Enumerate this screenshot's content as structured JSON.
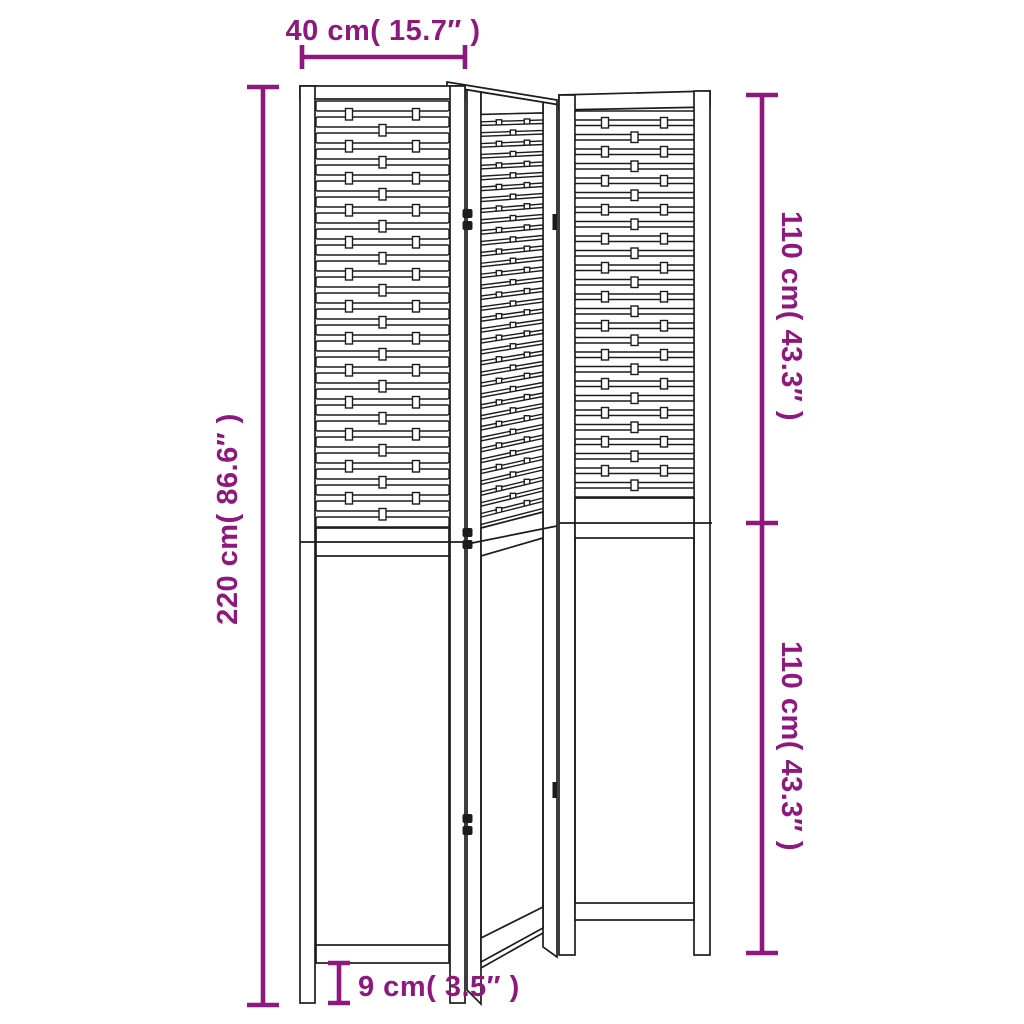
{
  "diagram": {
    "background_color": "#ffffff",
    "line_color": "#1c1c1c",
    "accent_color": "#8e187e",
    "product": "folding room divider, 3 panels, woven upper sections",
    "labels": {
      "panel_width": "40 cm( 15.7″ )",
      "total_height": "220 cm( 86.6″ )",
      "upper_section_height": "110 cm( 43.3″ )",
      "lower_section_height": "110 cm( 43.3″ )",
      "leg_height": "9 cm( 3.5″ )"
    },
    "values": {
      "panel_width_cm": 40,
      "panel_width_in": 15.7,
      "total_height_cm": 220,
      "total_height_in": 86.6,
      "upper_section_cm": 110,
      "upper_section_in": 43.3,
      "lower_section_cm": 110,
      "lower_section_in": 43.3,
      "leg_height_cm": 9,
      "leg_height_in": 3.5
    }
  }
}
